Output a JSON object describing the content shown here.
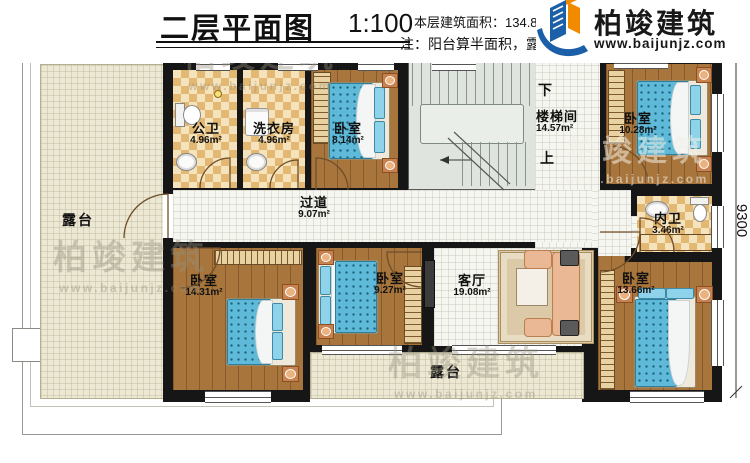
{
  "dimensions": {
    "width_top": "18700",
    "height_right": "9300"
  },
  "plan": {
    "rooms": {
      "terrace_left": {
        "name": "露台"
      },
      "public_bath": {
        "name": "公卫",
        "area": "4.96m²"
      },
      "laundry": {
        "name": "洗衣房",
        "area": "4.96m²"
      },
      "bedroom_top": {
        "name": "卧室",
        "area": "8.14m²"
      },
      "stairwell": {
        "name": "楼梯间",
        "area": "14.57m²"
      },
      "bedroom_topright": {
        "name": "卧室",
        "area": "10.28m²"
      },
      "corridor": {
        "name": "过道",
        "area": "9.07m²"
      },
      "inner_bath": {
        "name": "内卫",
        "area": "3.46m²"
      },
      "bedroom_left": {
        "name": "卧室",
        "area": "14.31m²"
      },
      "bedroom_mid": {
        "name": "卧室",
        "area": "9.27m²"
      },
      "living_room": {
        "name": "客厅",
        "area": "19.08m²"
      },
      "bedroom_right": {
        "name": "卧室",
        "area": "13.66m²"
      },
      "terrace_bottom": {
        "name": "露台"
      }
    },
    "stairs": {
      "down": "下",
      "up": "上"
    }
  },
  "title_block": {
    "title": "二层平面图",
    "scale": "1:100",
    "area_info": "本层建筑面积：134.85m²",
    "height_info": "层高：",
    "note": "注：阳台算半面积，露台不算面积"
  },
  "brand": {
    "name": "柏竣建筑",
    "url": "www.baijunjz.com"
  },
  "colors": {
    "wall": "#161616",
    "wood_floor": "#a8763c",
    "checker_light": "#f5e3bd",
    "checker_dark": "#e2b873",
    "terrace_floor": "#ece8d3",
    "stair_floor": "#dfe5de",
    "mattress_blue": "#5fb9d8",
    "logo_blue": "#1a5fa8",
    "logo_orange": "#f28a00"
  }
}
